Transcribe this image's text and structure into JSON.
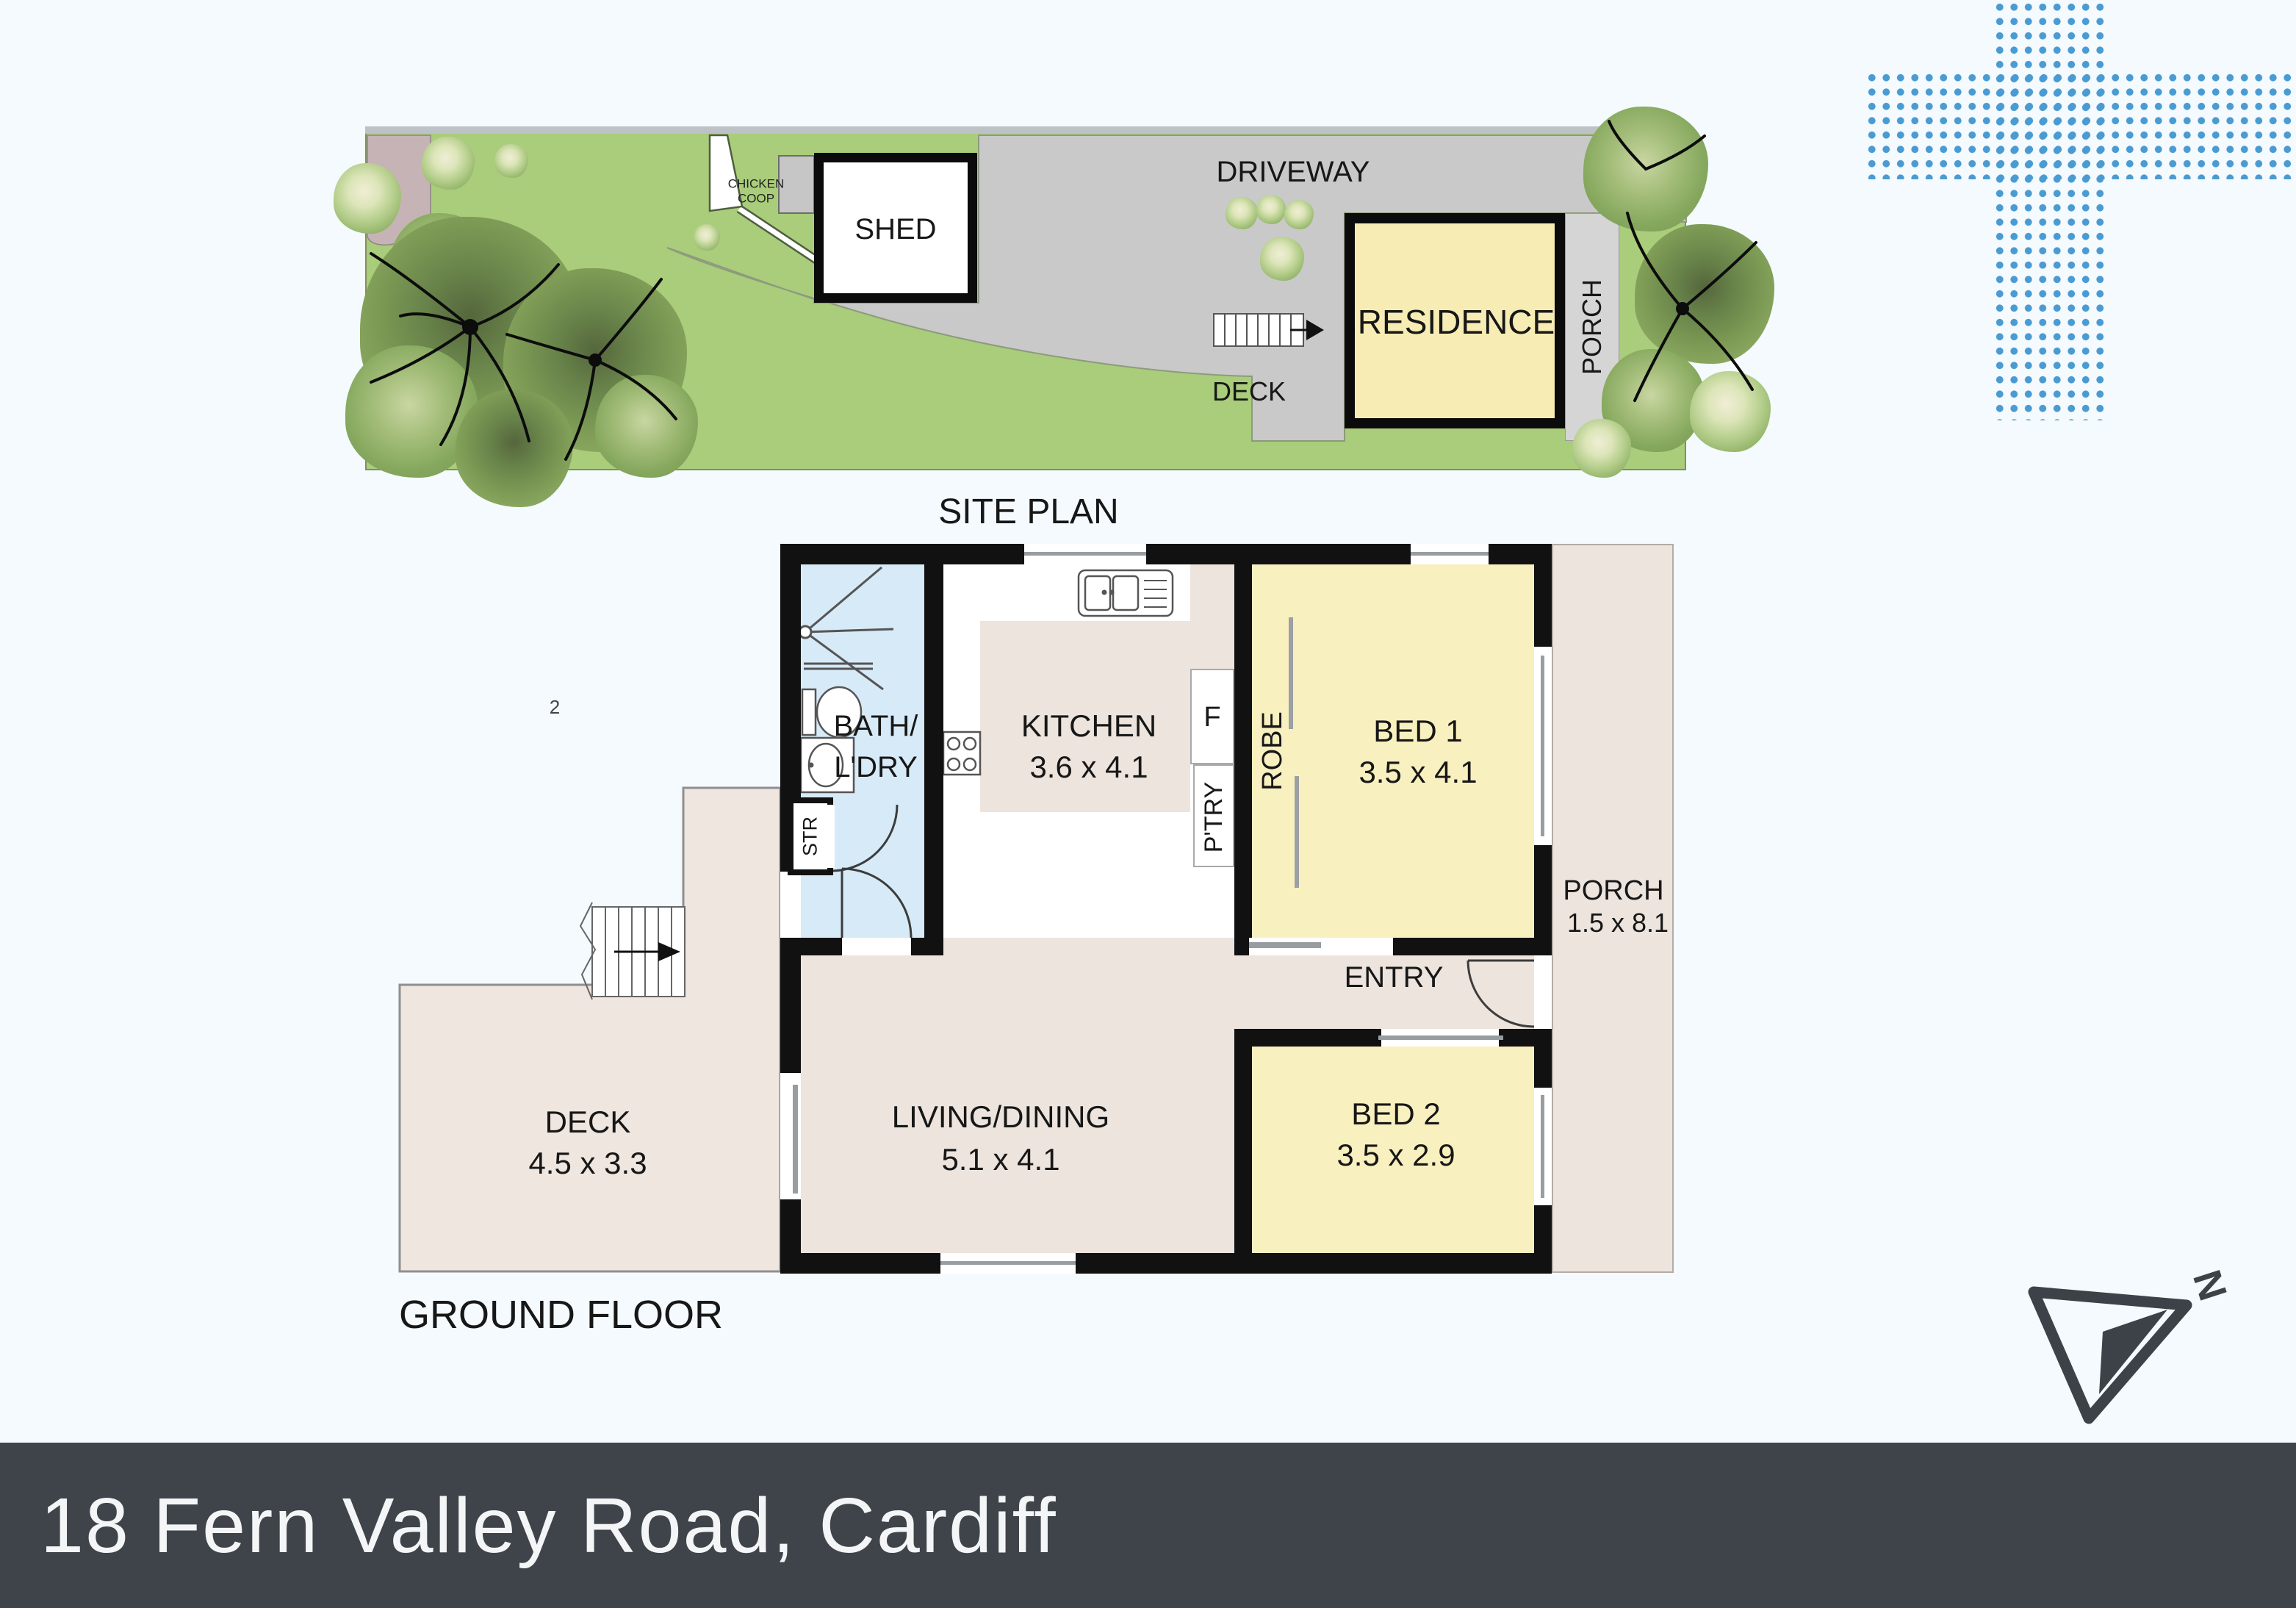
{
  "page": {
    "page_number": "2",
    "background": "#f4fafd"
  },
  "banner": {
    "address": "18 Fern Valley Road, Cardiff",
    "bg_color": "#3f444a",
    "text_color": "#f3f5f6"
  },
  "site_plan": {
    "title": "SITE PLAN",
    "labels": {
      "driveway": "DRIVEWAY",
      "shed": "SHED",
      "residence": "RESIDENCE",
      "porch": "PORCH",
      "deck": "DECK",
      "chicken_coop_line1": "CHICKEN",
      "chicken_coop_line2": "COOP"
    },
    "colors": {
      "grass": "#a9cd7a",
      "paving": "#c9c9c9",
      "residence_fill": "#f7edb4",
      "garden_bed": "#c6b3b5"
    }
  },
  "floor_plan": {
    "title": "GROUND FLOOR",
    "rooms": {
      "kitchen": {
        "name": "KITCHEN",
        "dims": "3.6 x 4.1"
      },
      "bed1": {
        "name": "BED 1",
        "dims": "3.5 x 4.1"
      },
      "bed2": {
        "name": "BED 2",
        "dims": "3.5 x 2.9"
      },
      "living": {
        "name": "LIVING/DINING",
        "dims": "5.1 x 4.1"
      },
      "deck": {
        "name": "DECK",
        "dims": "4.5 x 3.3"
      },
      "porch": {
        "name": "PORCH",
        "dims": "1.5 x 8.1"
      },
      "bath_line1": "BATH/",
      "bath_line2": "L'DRY",
      "entry": "ENTRY",
      "robe": "ROBE",
      "pantry": "P'TRY",
      "fridge": "F",
      "store": "STR"
    },
    "colors": {
      "bedroom_fill": "#f8f0bf",
      "bath_fill": "#d7eaf7",
      "floor_fill": "#ece4dd",
      "wall": "#111111"
    }
  },
  "compass": {
    "north_label": "N"
  },
  "decor": {
    "dot_color": "#4a9bd2"
  }
}
